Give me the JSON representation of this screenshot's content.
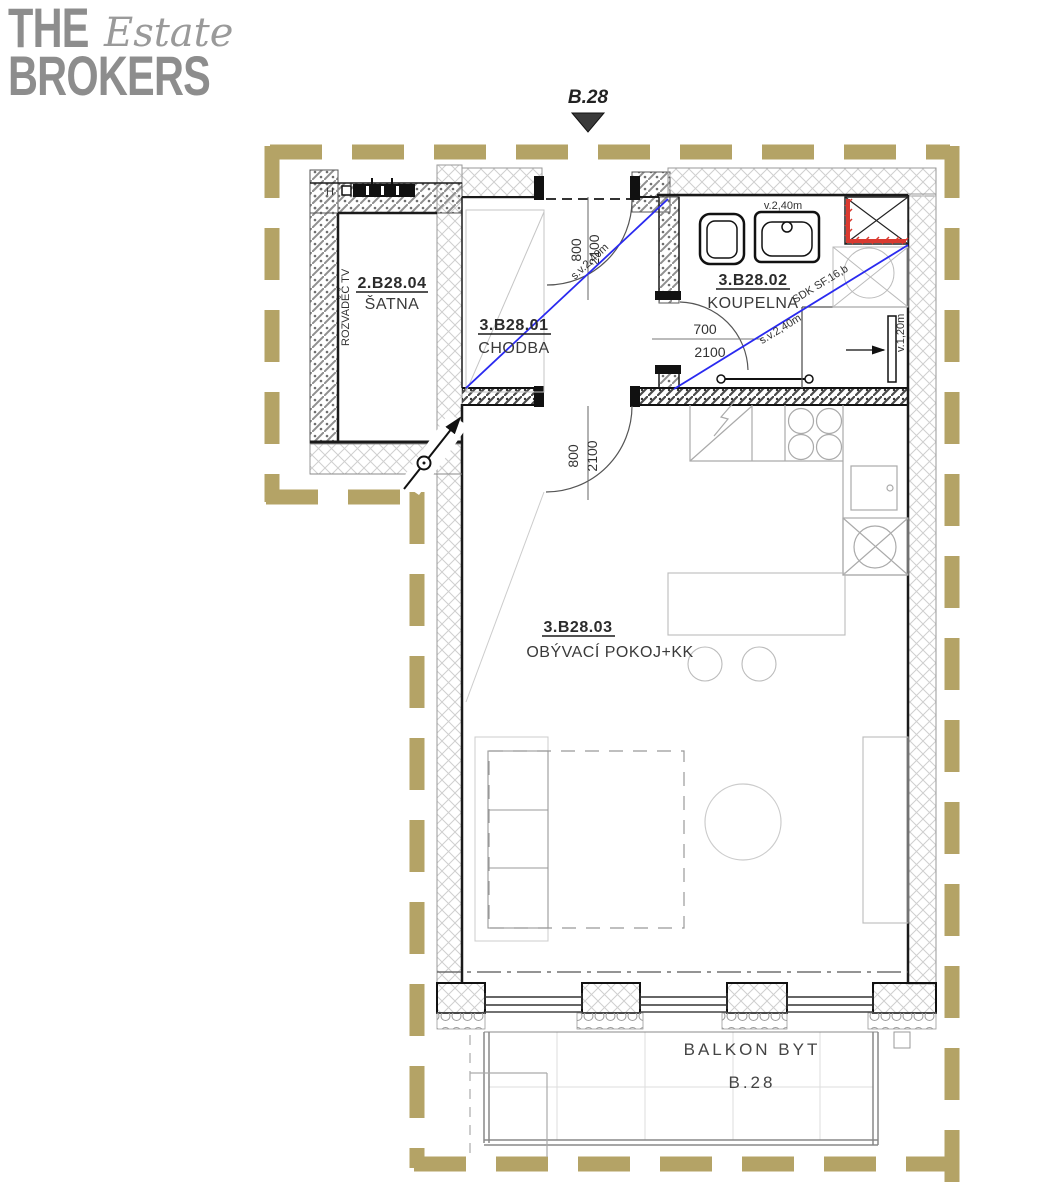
{
  "logo": {
    "the": "THE",
    "estate": "Estate",
    "brokers": "BROKERS"
  },
  "marker": {
    "label": "B.28"
  },
  "rooms": {
    "satna": {
      "code": "2.B28.04",
      "name": "ŠATNA"
    },
    "chodba": {
      "code": "3.B28.01",
      "name": "CHODBA"
    },
    "koupelna": {
      "code": "3.B28.02",
      "name": "KOUPELNA"
    },
    "obyvak": {
      "code": "3.B28.03",
      "name": "OBÝVACÍ POKOJ+KK"
    },
    "balkon": {
      "name": "BALKON BYT",
      "unit": "B.28"
    }
  },
  "dims": {
    "door_entry": {
      "w": "800",
      "h": "2100"
    },
    "door_living": {
      "w": "800",
      "h": "2100"
    },
    "door_bath": {
      "w": "700",
      "h": "2100"
    }
  },
  "annotations": {
    "rozvadec": "ROZVADĚČ TV",
    "h_label": "H",
    "sv_chodba": "s.v.2,40m",
    "v_koupelna": "v.2,40m",
    "sdk": "SDK SF.16,b",
    "sv_sprcha": "s.v.2,40m",
    "v_nika": "v.1,20m"
  },
  "colors": {
    "boundary_gold": "#b4a366",
    "highlight_red": "#d93a30",
    "diagonal_blue": "#2a2af0",
    "logo_gray": "#8d8d8d",
    "wall_black": "#1a1a1a"
  }
}
